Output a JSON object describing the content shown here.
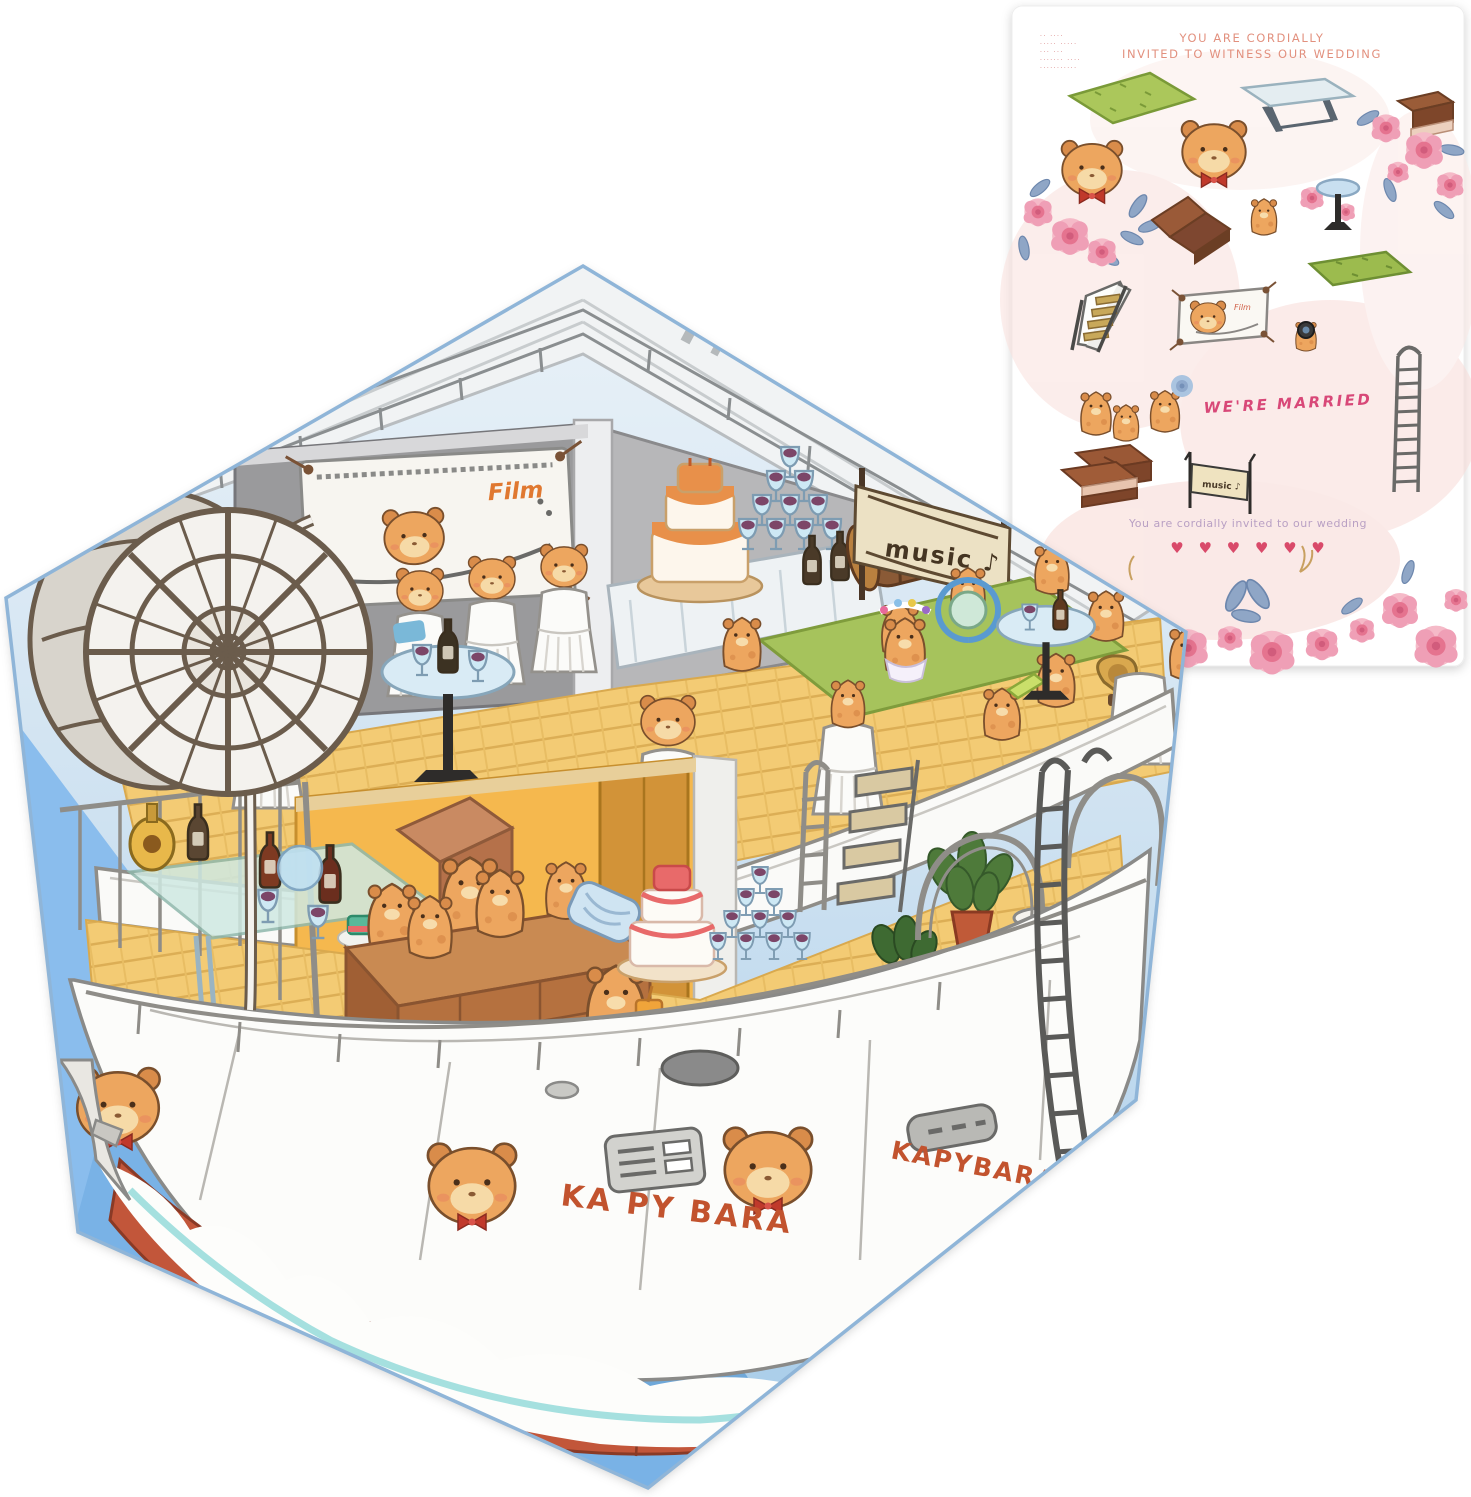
{
  "page": {
    "background": "#ffffff"
  },
  "sticker_sheet": {
    "fine_print_lines": [
      "·· ····",
      "····· ·····",
      "··· ···",
      "······· ····",
      "···········"
    ],
    "header_line1": "YOU ARE CORDIALLY",
    "header_line2": "INVITED TO WITNESS OUR WEDDING",
    "married_text": "WE'RE MARRIED",
    "film_banner_label": "Film",
    "music_banner_label": "music ♪",
    "invite_text": "You are cordially invited to our wedding",
    "hearts": "♥ ♥ ♥ ♥ ♥ ♥",
    "sticker_items": [
      "grass-mat",
      "banquet-table",
      "chocolate-sofa",
      "rose-bouquet",
      "capybara-face",
      "capybara-face",
      "chaise-lounge",
      "capybara",
      "cocktail-table",
      "staircase",
      "film-screen-banner",
      "grass-mat",
      "capybara-photographer",
      "rope-ladder",
      "capybara-couple",
      "capybara-with-flower",
      "chocolate-bars",
      "music-banner",
      "rose-garland"
    ]
  },
  "boat_card": {
    "film_screen_label": "Film",
    "music_banner_label": "music ♪",
    "hull_name_left": "KA PY BARA",
    "hull_name_right": "KAPYBARA"
  },
  "colors": {
    "card_border_blue": "#8fb5d8",
    "sky_blue": "#cfe2f1",
    "water_blue": "#8abded",
    "hull_red": "#c2563a",
    "deck_wood": "#f3cb74",
    "capybara_orange": "#eda65f",
    "grass_green": "#a9c557",
    "rose_pink": "#f0a4b8",
    "heart_pink": "#d94a6a",
    "header_coral": "#e2907e",
    "married_pink": "#d84878",
    "invite_lilac": "#b9a0c4",
    "hull_text_rust": "#c2532e"
  }
}
